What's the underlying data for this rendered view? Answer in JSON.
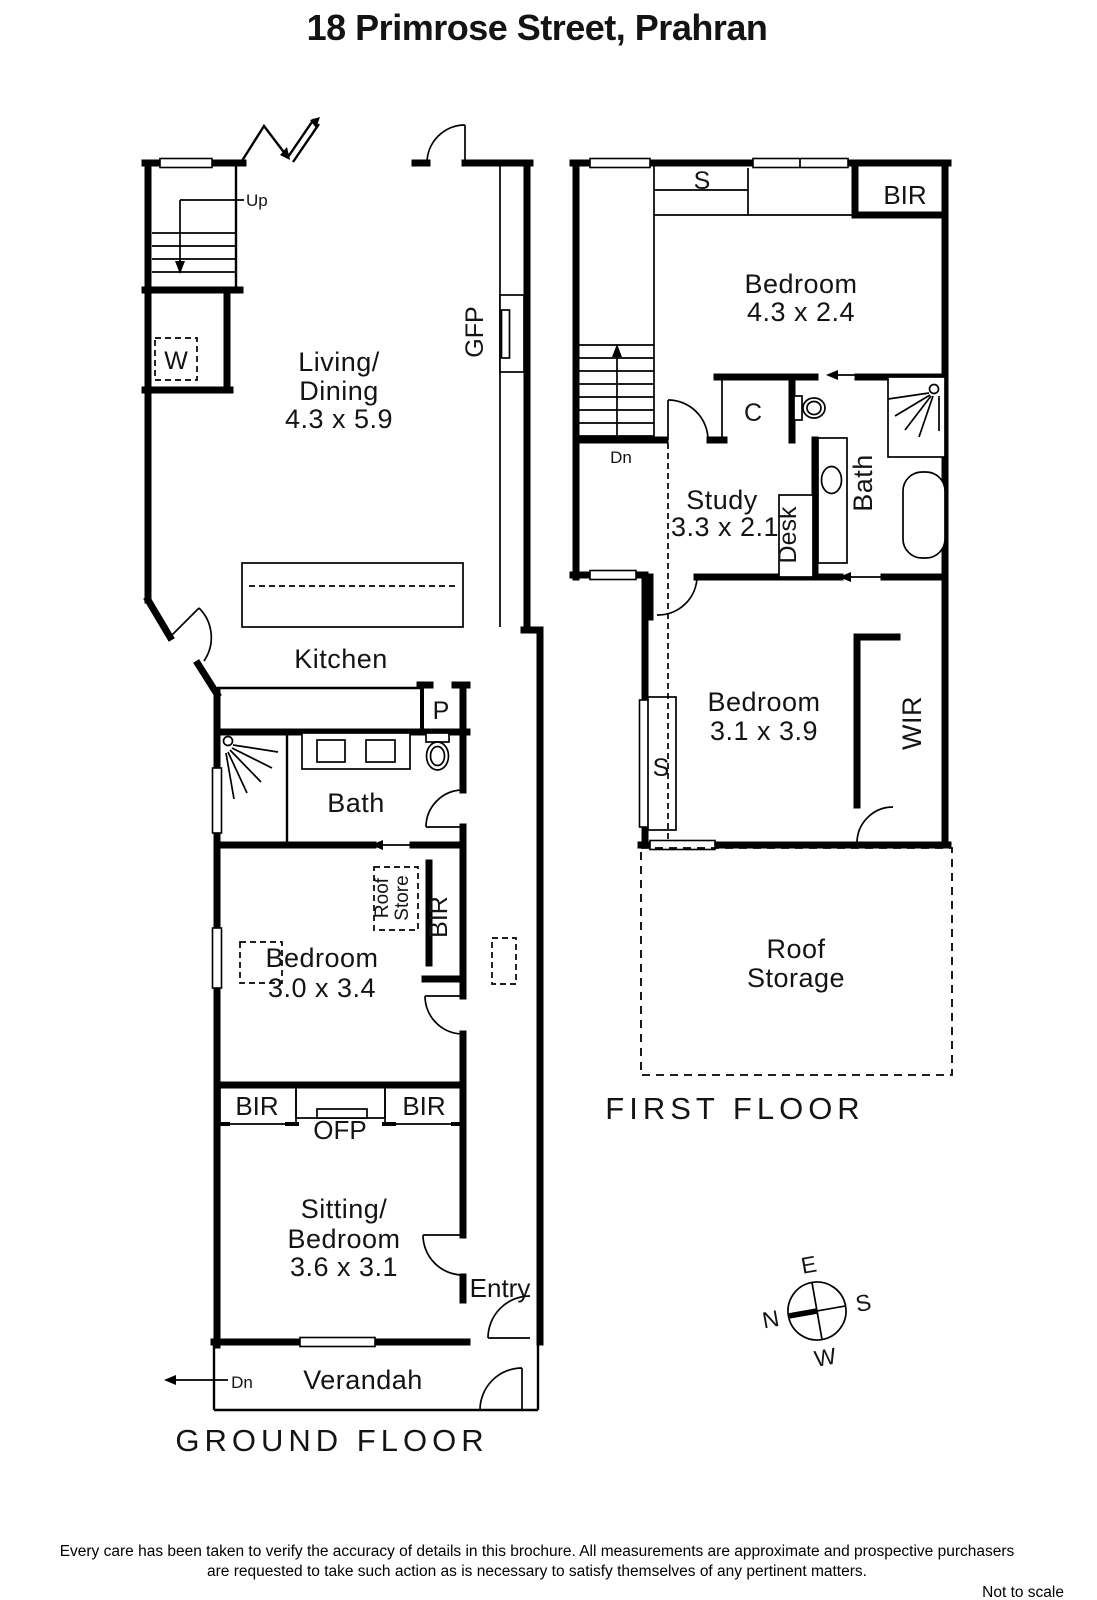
{
  "title": "18 Primrose Street,  Prahran",
  "ground_floor": {
    "label": "GROUND FLOOR",
    "stairs_up": "Up",
    "washer": "W",
    "living_dining": {
      "line1": "Living/",
      "line2": "Dining",
      "dims": "4.3 x 5.9"
    },
    "gas_fireplace": "GFP",
    "kitchen": "Kitchen",
    "pantry": "P",
    "bath": "Bath",
    "roof_store": {
      "line1": "Roof",
      "line2": "Store"
    },
    "bir_hall": "BIR",
    "bedroom": {
      "name": "Bedroom",
      "dims": "3.0 x 3.4"
    },
    "bir_left": "BIR",
    "open_fireplace": "OFP",
    "bir_right": "BIR",
    "sitting_bedroom": {
      "line1": "Sitting/",
      "line2": "Bedroom",
      "dims": "3.6 x 3.1"
    },
    "entry": "Entry",
    "verandah": "Verandah",
    "dn": "Dn"
  },
  "first_floor": {
    "label": "FIRST FLOOR",
    "storage_s": "S",
    "bir_top": "BIR",
    "bedroom1": {
      "name": "Bedroom",
      "dims": "4.3 x 2.4"
    },
    "cupboard": "C",
    "dn": "Dn",
    "study": {
      "name": "Study",
      "dims": "3.3 x 2.1"
    },
    "desk": "Desk",
    "bath": "Bath",
    "wardrobe_s": "S",
    "bedroom2": {
      "name": "Bedroom",
      "dims": "3.1 x 3.9"
    },
    "wir": "WIR",
    "roof_storage": {
      "line1": "Roof",
      "line2": "Storage"
    }
  },
  "compass": {
    "n": "N",
    "e": "E",
    "s": "S",
    "w": "W"
  },
  "footer": {
    "line1": "Every care has been taken to verify the accuracy of details in this brochure.  All measurements are approximate and prospective purchasers",
    "line2": "are requested to take such action as is necessary to satisfy themselves of any pertinent matters.",
    "not_to_scale": "Not to scale"
  }
}
